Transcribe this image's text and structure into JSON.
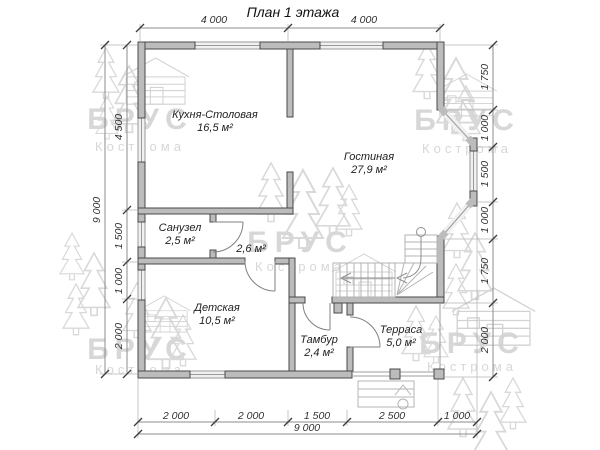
{
  "title": "План 1 этажа",
  "watermark": {
    "brand": "БРУС",
    "city": "Кострома"
  },
  "rooms": {
    "kitchen": {
      "name": "Кухня-Столовая",
      "area": "16,5 м²"
    },
    "living": {
      "name": "Гостиная",
      "area": "27,9 м²"
    },
    "bathroom": {
      "name": "Санузел",
      "area": "2,5 м²"
    },
    "hall": {
      "name": "",
      "area": "2,6 м²"
    },
    "kids": {
      "name": "Детская",
      "area": "10,5 м²"
    },
    "vestibule": {
      "name": "Тамбур",
      "area": "2,4 м²"
    },
    "terrace": {
      "name": "Терраса",
      "area": "5,0 м²"
    }
  },
  "dims": {
    "top": [
      "4 000",
      "4 000"
    ],
    "left": [
      "4 500",
      "1 500",
      "1 000",
      "2 000"
    ],
    "left_total": "9 000",
    "right": [
      "1 750",
      "1 000",
      "1 500",
      "1 000",
      "1 750",
      "2 000"
    ],
    "bottom": [
      "2 000",
      "2 000",
      "1 500",
      "2 500",
      "1 000"
    ],
    "bottom_total": "9 000"
  }
}
